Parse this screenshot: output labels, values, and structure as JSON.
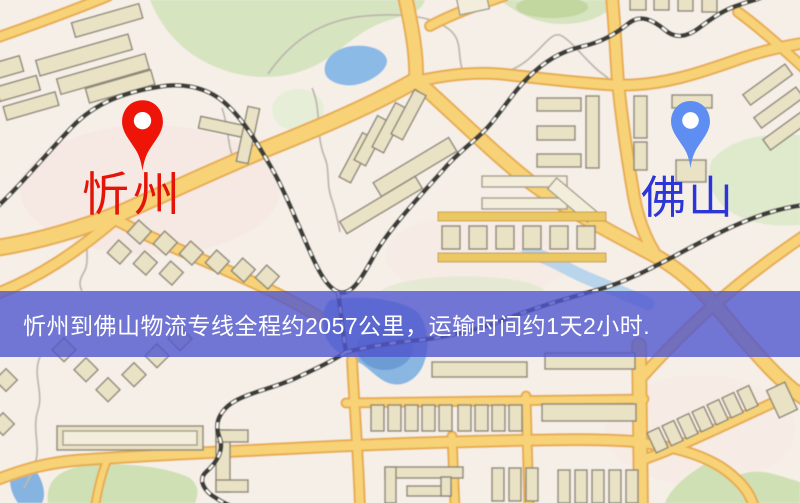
{
  "banner": {
    "text": "忻州到佛山物流专线全程约2057公里，运输时间约1天2小时.",
    "background_color": "#5056ce",
    "text_color": "#ffffff"
  },
  "markers": {
    "origin": {
      "label": "忻州",
      "pin_color": "#ee1408",
      "label_color": "#e41408"
    },
    "destination": {
      "label": "佛山",
      "pin_color": "#5f8ef3",
      "label_color": "#2c35d6"
    }
  },
  "route": {
    "distance_km": "2057",
    "duration": "1天2小时"
  },
  "map_palette": {
    "background": "#f6efe8",
    "road_fill": "#f7d277",
    "road_edge": "#e7ac4f",
    "water": "#8cbae6",
    "green_area": "#d6e4c0",
    "building": "#eae2c4",
    "railway": "#3e3c38"
  }
}
